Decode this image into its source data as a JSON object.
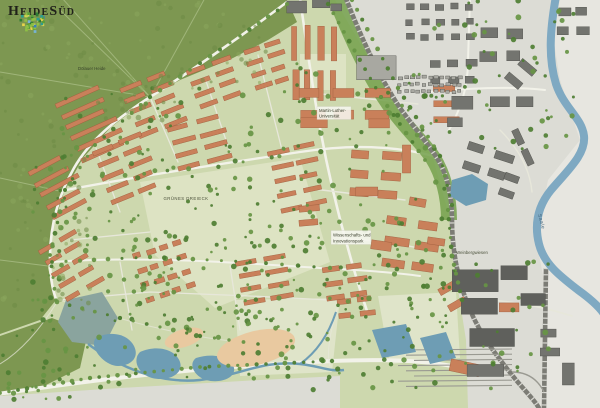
{
  "logo": {
    "text": "HeideSüd",
    "icon": "mosaic-tree-icon"
  },
  "labels": {
    "forest": "Dölauer Heide",
    "district": "Grünes Dreieck",
    "university1": "Martin-Luther-",
    "university2": "Universität",
    "science1": "Wissenschafts- und",
    "science2": "Innovationspark",
    "meadow": "Weinbergwiesen",
    "river": "Saale"
  },
  "palette": {
    "base": "#dcdcd5",
    "beyondRiver": "#e7e6e0",
    "devGreen": "#cdd8ae",
    "meadow": "#dde3c3",
    "parkPale": "#dfe4c9",
    "forest": "#7d9751",
    "forestPath": "#a9bd85",
    "forestTex": "#6e8a45",
    "forestTex2": "#8aa55c",
    "road": "#f2f2e9",
    "roadMinor": "#e7e7da",
    "bldOrange": "#c9805a",
    "bldOrangeStroke": "#9e5c3c",
    "bldGray": "#73746f",
    "bldGrayDark": "#5f605c",
    "bldGrayLight": "#a8a8a1",
    "bldStrokeGray": "#4d4e49",
    "tree": "#4e7e33",
    "treeLight": "#679544",
    "greenStrip": "#74a14c",
    "water": "#7fa9c2",
    "pond": "#6e9db4",
    "pondMuted": "#8aa49e",
    "sand": "#e9c9a0",
    "rail": "#7c7c75",
    "railTie": "#d8d8d2"
  }
}
